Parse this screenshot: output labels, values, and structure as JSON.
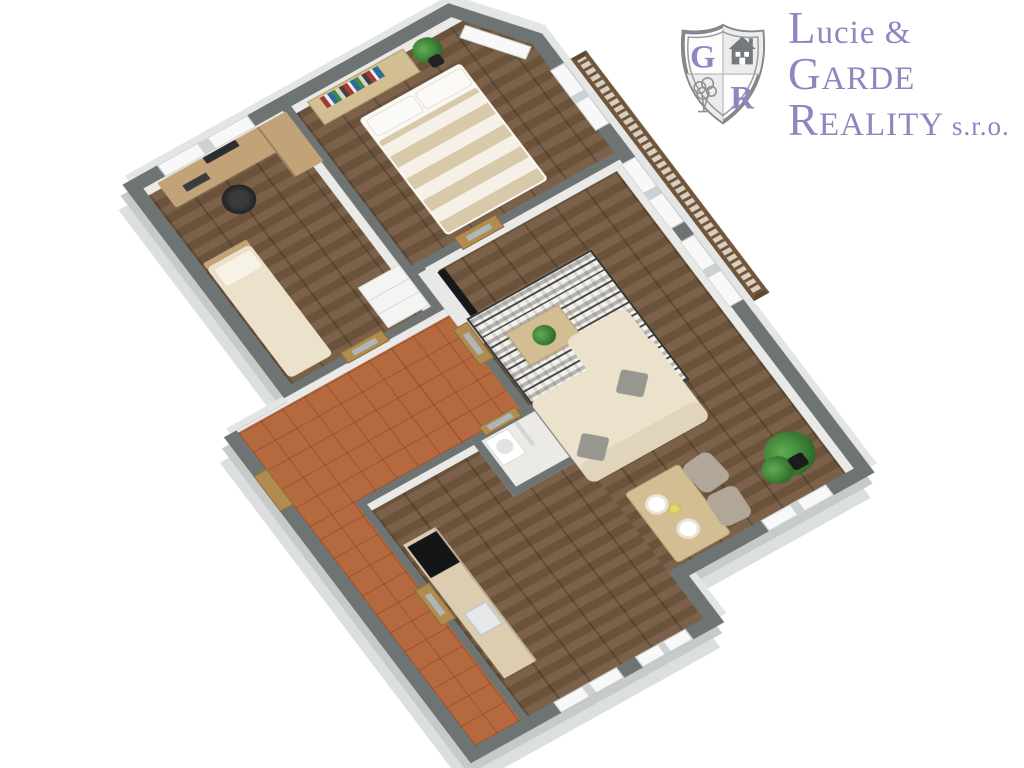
{
  "brand": {
    "line1": "Lucie &",
    "line2": "GARDE",
    "line3": "REALITY",
    "suffix": " s.r.o.",
    "monogram_g": "G",
    "monogram_r": "R"
  },
  "colors": {
    "wall_top": "#6e7473",
    "wall_side_light": "#dcdfdf",
    "wall_side_mid": "#c6cac9",
    "wall_side_ne": "#e4e6e6",
    "inner_wall_face": "#e9eae8",
    "floor_wood": "#74593f",
    "floor_tile": "#b5693f",
    "floor_bath": "#eceae5",
    "wood_light": "#d3bd92",
    "wood_mid": "#c2a377",
    "wood_dark": "#6f5539",
    "counter": "#dccdb0",
    "cream": "#ece1cb",
    "white_furn": "#f4f4f2",
    "rug": "#f2f1ec",
    "plant": "#46863b",
    "plant_dark": "#2f6b2a",
    "tv": "#17181a",
    "black_furn": "#232325",
    "door_wood": "#b08c50",
    "door_glass": "#aeb6b9",
    "window_white": "#f7f8f7",
    "chair_gray": "#b0a799",
    "pillow_gray": "#97978f",
    "stripe_beige": "#d9c9ab",
    "stripe_white": "#f5f1e7",
    "logo_purple": "#9184bf",
    "logo_gray": "#84888a"
  },
  "floorplan": {
    "view": "3d-isometric-cutaway",
    "rooms": [
      {
        "id": "office",
        "floor": "wood",
        "furniture": [
          "desk",
          "monitor",
          "keyboard",
          "office-chair",
          "cabinet",
          "single-bed",
          "wardrobe",
          "window"
        ]
      },
      {
        "id": "bedroom",
        "floor": "wood",
        "furniture": [
          "double-bed-striped",
          "dresser",
          "books",
          "potted-plant",
          "balcony-door",
          "window"
        ]
      },
      {
        "id": "living-room",
        "floor": "wood",
        "furniture": [
          "wall-tv",
          "patterned-rug",
          "coffee-table",
          "plant",
          "sofa",
          "chaise",
          "pillows",
          "french-windows"
        ]
      },
      {
        "id": "dining-area",
        "floor": "wood",
        "furniture": [
          "dining-table",
          "plates",
          "flowers",
          "two-chairs",
          "corner-plant",
          "window"
        ]
      },
      {
        "id": "hallway",
        "floor": "terracotta-tile",
        "furniture": [
          "glazed-wood-doors",
          "entrance-door"
        ]
      },
      {
        "id": "bathroom",
        "floor": "light-tile",
        "furniture": [
          "sink",
          "shower-screen"
        ]
      },
      {
        "id": "kitchen",
        "floor": "wood",
        "furniture": [
          "counter",
          "black-appliance",
          "sink",
          "windows"
        ]
      },
      {
        "id": "balcony",
        "floor": "none",
        "furniture": [
          "wood-railing"
        ]
      }
    ]
  }
}
